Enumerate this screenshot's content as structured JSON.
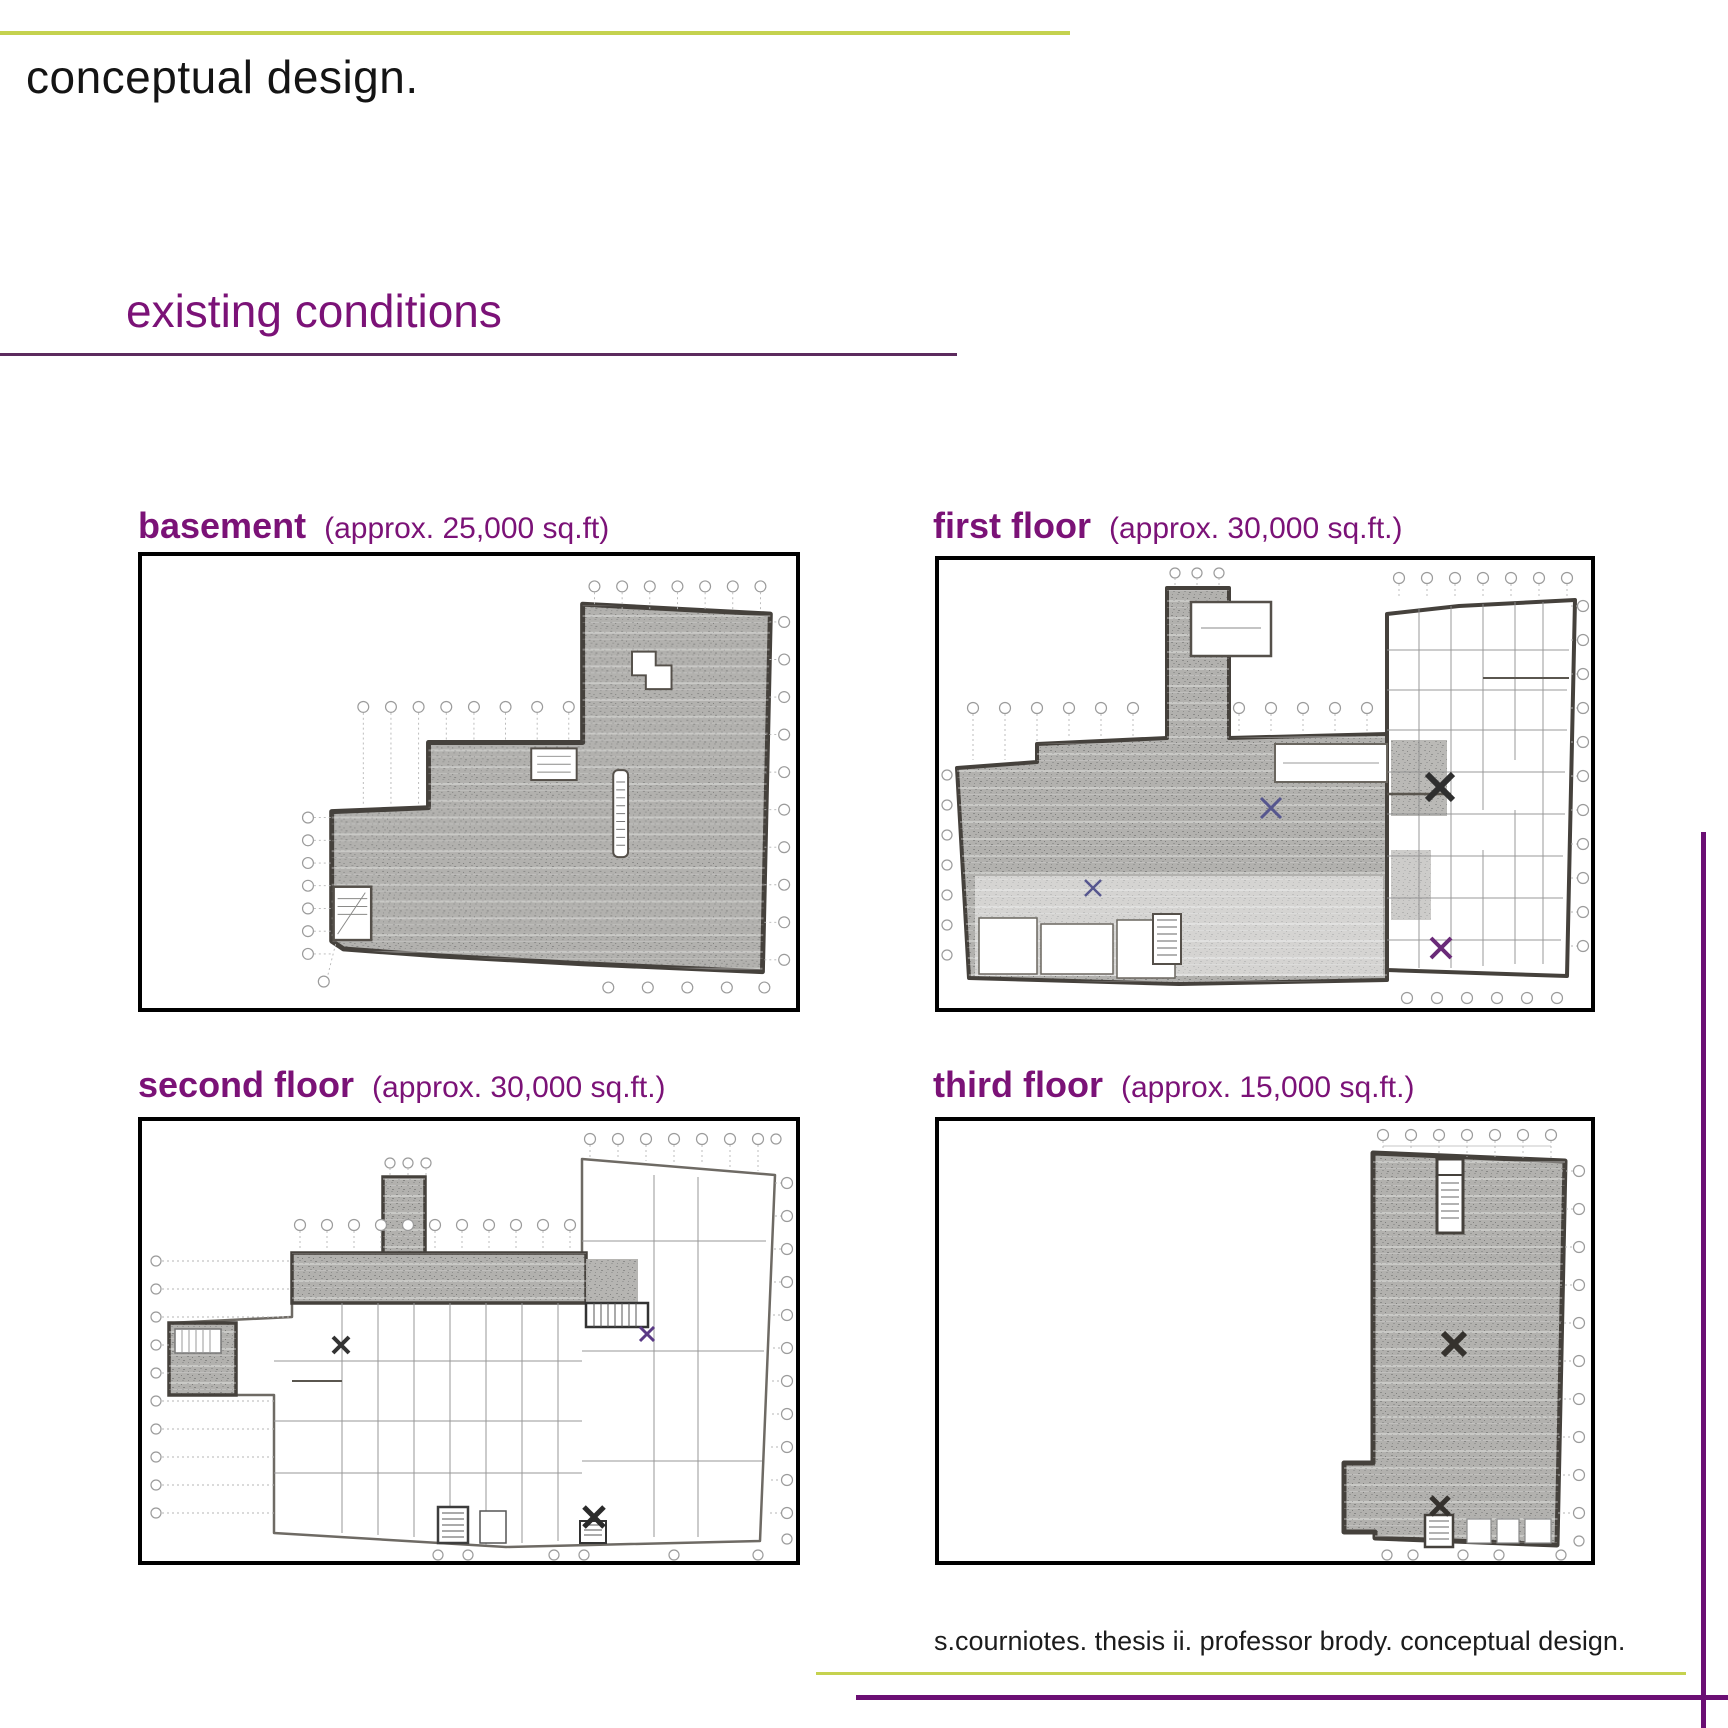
{
  "slide": {
    "title": "conceptual design.",
    "section_heading": "existing conditions",
    "footer": "s.courniotes. thesis ii. professor brody. conceptual design."
  },
  "plans": [
    {
      "name": "basement",
      "area_note": "(approx. 25,000 sq.ft)"
    },
    {
      "name": "first floor",
      "area_note": "(approx. 30,000 sq.ft.)"
    },
    {
      "name": "second floor",
      "area_note": "(approx. 30,000 sq.ft.)"
    },
    {
      "name": "third floor",
      "area_note": "(approx. 15,000 sq.ft.)"
    }
  ],
  "colors": {
    "accent_green": "#c5d24f",
    "heading_purple": "#7b1277",
    "divider_purple": "#5c2a5e",
    "frame_purple": "#6b0f74",
    "plan_frame_black": "#000000",
    "scan_gray": "#b2b1ae"
  }
}
